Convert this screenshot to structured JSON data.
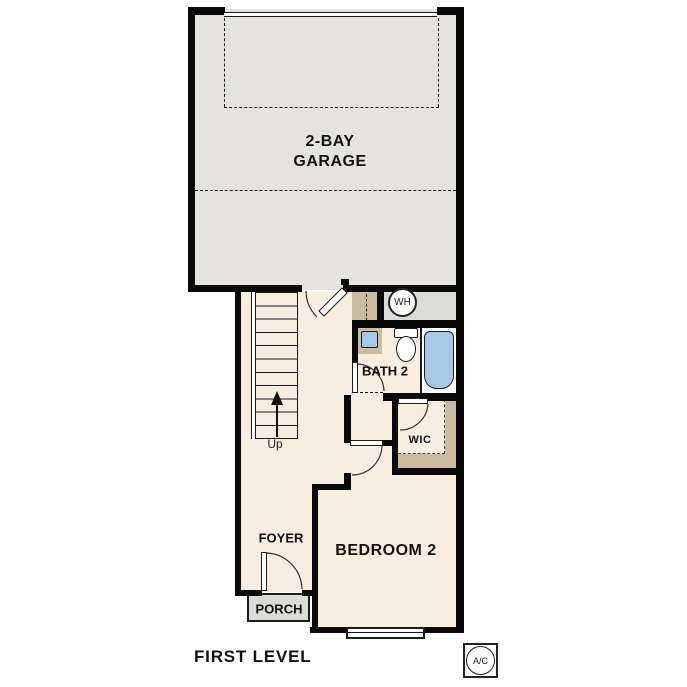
{
  "title": "FIRST LEVEL",
  "rooms": {
    "garage": {
      "label_line1": "2-BAY",
      "label_line2": "GARAGE"
    },
    "bath": {
      "label": "BATH 2"
    },
    "wic": {
      "label": "WIC"
    },
    "bedroom": {
      "label": "BEDROOM 2"
    },
    "foyer": {
      "label": "FOYER"
    },
    "porch": {
      "label": "PORCH"
    }
  },
  "stairs": {
    "direction_label": "Up"
  },
  "equipment": {
    "water_heater_label": "WH",
    "air_conditioner_label": "A/C"
  },
  "colors": {
    "wall_black": "#0a0a0a",
    "floor_cream": "#f7eee0",
    "garage_gray": "#e4e3e0",
    "concrete_gray": "#dbdbd8",
    "cabinet_tan": "#cabba1",
    "fixture_blue": "#a9c7e7"
  }
}
